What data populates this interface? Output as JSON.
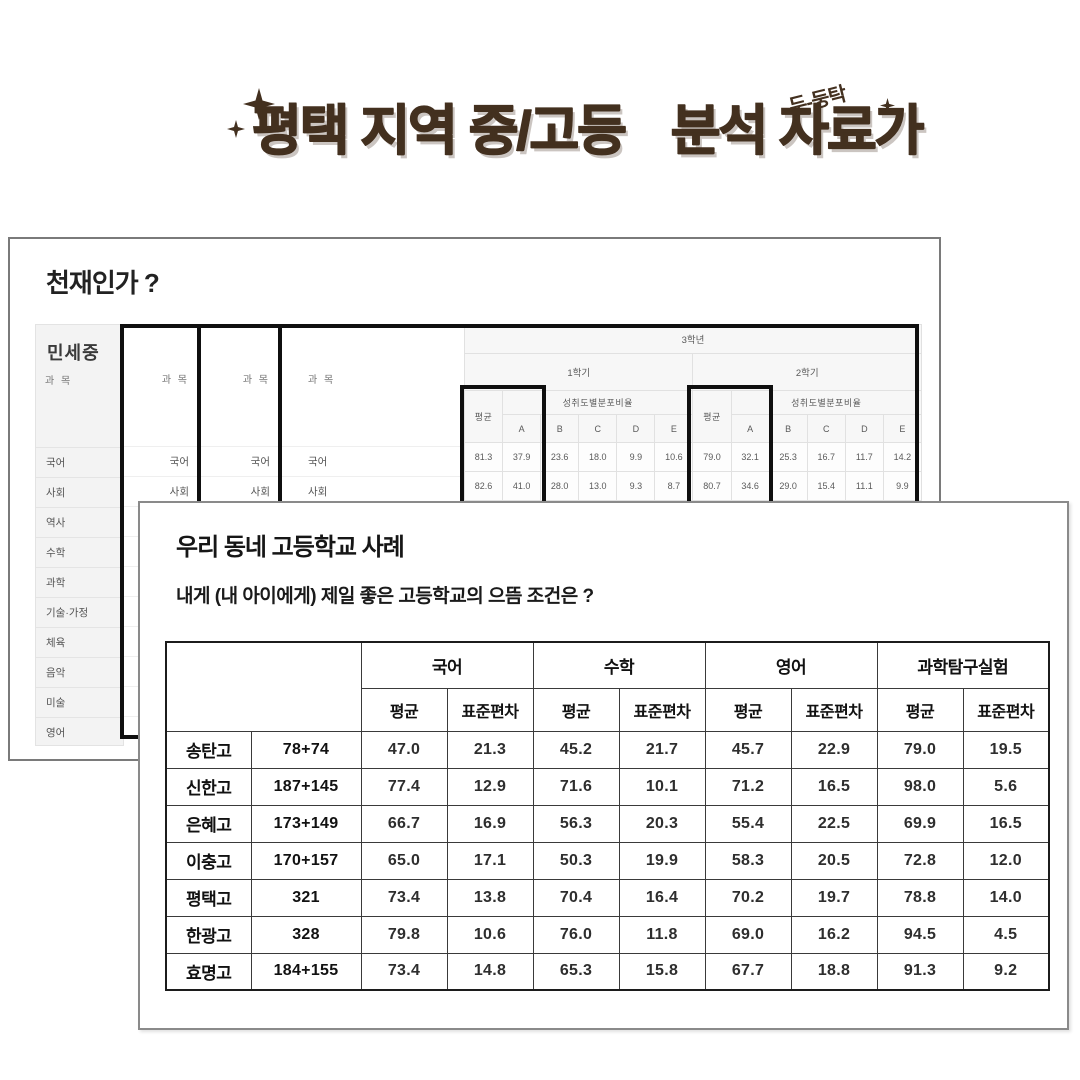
{
  "header": {
    "title_part1": "평택 지역 중/고등",
    "title_part2": "분석 자료가",
    "badge": "두-둥탁",
    "accent_color": "#43301f"
  },
  "genius_card": {
    "heading": "천재인가 ?",
    "student_name": "민세중",
    "subject_label": "과 목",
    "subjects": [
      "국어",
      "사회",
      "역사",
      "수학",
      "과학",
      "기술·가정",
      "체육",
      "음악",
      "미술",
      "영어"
    ],
    "grade_table": {
      "grade_header": "3학년",
      "semester1": "1학기",
      "semester2": "2학기",
      "avg_label": "평균",
      "dist_label": "성취도별분포비율",
      "levels": [
        "A",
        "B",
        "C",
        "D",
        "E"
      ],
      "highlight_color": "#0f0f0f",
      "rows": [
        {
          "subject": "국어",
          "s1": [
            "81.3",
            "37.9",
            "23.6",
            "18.0",
            "9.9",
            "10.6"
          ],
          "s2": [
            "79.0",
            "32.1",
            "25.3",
            "16.7",
            "11.7",
            "14.2"
          ]
        },
        {
          "subject": "사회",
          "s1": [
            "82.6",
            "41.0",
            "28.0",
            "13.0",
            "9.3",
            "8.7"
          ],
          "s2": [
            "80.7",
            "34.6",
            "29.0",
            "15.4",
            "11.1",
            "9.9"
          ]
        }
      ]
    }
  },
  "case_card": {
    "heading": "우리 동네 고등학교 사례",
    "question": "내게 (내 아이에게) 제일 좋은 고등학교의 으뜸 조건은 ?",
    "table": {
      "subject_groups": [
        "국어",
        "수학",
        "영어",
        "과학탐구실험"
      ],
      "metric_labels": [
        "평균",
        "표준편차"
      ],
      "rows": [
        {
          "school": "송탄고",
          "students": "78+74",
          "values": [
            "47.0",
            "21.3",
            "45.2",
            "21.7",
            "45.7",
            "22.9",
            "79.0",
            "19.5"
          ]
        },
        {
          "school": "신한고",
          "students": "187+145",
          "values": [
            "77.4",
            "12.9",
            "71.6",
            "10.1",
            "71.2",
            "16.5",
            "98.0",
            "5.6"
          ]
        },
        {
          "school": "은혜고",
          "students": "173+149",
          "values": [
            "66.7",
            "16.9",
            "56.3",
            "20.3",
            "55.4",
            "22.5",
            "69.9",
            "16.5"
          ]
        },
        {
          "school": "이충고",
          "students": "170+157",
          "values": [
            "65.0",
            "17.1",
            "50.3",
            "19.9",
            "58.3",
            "20.5",
            "72.8",
            "12.0"
          ]
        },
        {
          "school": "평택고",
          "students": "321",
          "values": [
            "73.4",
            "13.8",
            "70.4",
            "16.4",
            "70.2",
            "19.7",
            "78.8",
            "14.0"
          ]
        },
        {
          "school": "한광고",
          "students": "328",
          "values": [
            "79.8",
            "10.6",
            "76.0",
            "11.8",
            "69.0",
            "16.2",
            "94.5",
            "4.5"
          ]
        },
        {
          "school": "효명고",
          "students": "184+155",
          "values": [
            "73.4",
            "14.8",
            "65.3",
            "15.8",
            "67.7",
            "18.8",
            "91.3",
            "9.2"
          ]
        }
      ]
    }
  }
}
